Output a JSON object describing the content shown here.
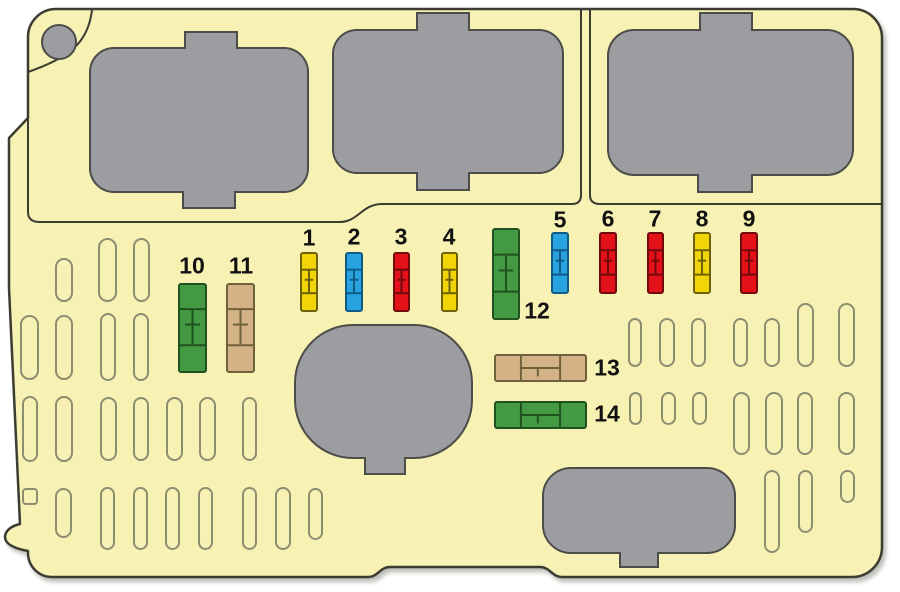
{
  "colors": {
    "canvas_bg": "#ffffff",
    "panel_fill": "#f7f2b4",
    "panel_stroke": "#3c3c33",
    "cover_fill": "#9b9da1",
    "cover_stroke": "#4c4d48",
    "slot_stroke": "#8d8d70",
    "label_color": "#111111"
  },
  "fuse_colors": {
    "yellow": {
      "fill": "#f2d506",
      "stroke": "#6e6106"
    },
    "blue": {
      "fill": "#28a3df",
      "stroke": "#0e5c85"
    },
    "red": {
      "fill": "#e41119",
      "stroke": "#700a0d"
    },
    "green": {
      "fill": "#449a42",
      "stroke": "#1e521f"
    },
    "tan": {
      "fill": "#d3b385",
      "stroke": "#71603c"
    }
  },
  "fuses": [
    {
      "number": "1",
      "color": "yellow",
      "orientation": "vertical",
      "x": 300,
      "y": 252,
      "w": 18,
      "h": 60,
      "label": {
        "x": 309,
        "y": 238
      }
    },
    {
      "number": "2",
      "color": "blue",
      "orientation": "vertical",
      "x": 345,
      "y": 252,
      "w": 18,
      "h": 60,
      "label": {
        "x": 354,
        "y": 237
      }
    },
    {
      "number": "3",
      "color": "red",
      "orientation": "vertical",
      "x": 393,
      "y": 252,
      "w": 17,
      "h": 60,
      "label": {
        "x": 401,
        "y": 237
      }
    },
    {
      "number": "4",
      "color": "yellow",
      "orientation": "vertical",
      "x": 441,
      "y": 252,
      "w": 17,
      "h": 60,
      "label": {
        "x": 449,
        "y": 237
      }
    },
    {
      "number": "5",
      "color": "blue",
      "orientation": "vertical",
      "x": 551,
      "y": 232,
      "w": 18,
      "h": 62,
      "label": {
        "x": 560,
        "y": 220
      }
    },
    {
      "number": "6",
      "color": "red",
      "orientation": "vertical",
      "x": 599,
      "y": 232,
      "w": 18,
      "h": 62,
      "label": {
        "x": 608,
        "y": 219
      }
    },
    {
      "number": "7",
      "color": "red",
      "orientation": "vertical",
      "x": 647,
      "y": 232,
      "w": 17,
      "h": 62,
      "label": {
        "x": 655,
        "y": 219
      }
    },
    {
      "number": "8",
      "color": "yellow",
      "orientation": "vertical",
      "x": 693,
      "y": 232,
      "w": 18,
      "h": 62,
      "label": {
        "x": 702,
        "y": 219
      }
    },
    {
      "number": "9",
      "color": "red",
      "orientation": "vertical",
      "x": 740,
      "y": 232,
      "w": 18,
      "h": 62,
      "label": {
        "x": 749,
        "y": 219
      }
    },
    {
      "number": "10",
      "color": "green",
      "orientation": "vertical",
      "x": 178,
      "y": 283,
      "w": 29,
      "h": 90,
      "label": {
        "x": 192,
        "y": 266
      }
    },
    {
      "number": "11",
      "color": "tan",
      "orientation": "vertical",
      "x": 226,
      "y": 283,
      "w": 29,
      "h": 90,
      "label": {
        "x": 241,
        "y": 266
      }
    },
    {
      "number": "12",
      "color": "green",
      "orientation": "vertical",
      "x": 492,
      "y": 228,
      "w": 28,
      "h": 92,
      "label": {
        "x": 537,
        "y": 311
      }
    },
    {
      "number": "13",
      "color": "tan",
      "orientation": "horizontal",
      "x": 494,
      "y": 354,
      "w": 93,
      "h": 28,
      "label": {
        "x": 607,
        "y": 368
      }
    },
    {
      "number": "14",
      "color": "green",
      "orientation": "horizontal",
      "x": 494,
      "y": 401,
      "w": 93,
      "h": 28,
      "label": {
        "x": 607,
        "y": 414
      }
    }
  ],
  "empty_slots": [
    {
      "x": 55,
      "y": 258,
      "w": 18,
      "h": 44
    },
    {
      "x": 98,
      "y": 238,
      "w": 19,
      "h": 64
    },
    {
      "x": 133,
      "y": 238,
      "w": 17,
      "h": 64
    },
    {
      "x": 20,
      "y": 315,
      "w": 19,
      "h": 65
    },
    {
      "x": 55,
      "y": 315,
      "w": 18,
      "h": 65
    },
    {
      "x": 100,
      "y": 313,
      "w": 16,
      "h": 68
    },
    {
      "x": 133,
      "y": 313,
      "w": 16,
      "h": 68
    },
    {
      "x": 22,
      "y": 396,
      "w": 16,
      "h": 66
    },
    {
      "x": 55,
      "y": 396,
      "w": 18,
      "h": 66
    },
    {
      "x": 100,
      "y": 397,
      "w": 17,
      "h": 64
    },
    {
      "x": 133,
      "y": 397,
      "w": 16,
      "h": 64
    },
    {
      "x": 166,
      "y": 397,
      "w": 17,
      "h": 64
    },
    {
      "x": 199,
      "y": 397,
      "w": 17,
      "h": 64
    },
    {
      "x": 242,
      "y": 397,
      "w": 15,
      "h": 64
    },
    {
      "x": 22,
      "y": 488,
      "w": 16,
      "h": 17,
      "r": 4
    },
    {
      "x": 55,
      "y": 488,
      "w": 17,
      "h": 50
    },
    {
      "x": 100,
      "y": 487,
      "w": 15,
      "h": 63
    },
    {
      "x": 133,
      "y": 487,
      "w": 15,
      "h": 63
    },
    {
      "x": 165,
      "y": 487,
      "w": 15,
      "h": 63
    },
    {
      "x": 198,
      "y": 487,
      "w": 15,
      "h": 63
    },
    {
      "x": 242,
      "y": 487,
      "w": 15,
      "h": 63
    },
    {
      "x": 275,
      "y": 487,
      "w": 16,
      "h": 63
    },
    {
      "x": 308,
      "y": 488,
      "w": 15,
      "h": 52
    },
    {
      "x": 628,
      "y": 318,
      "w": 14,
      "h": 49
    },
    {
      "x": 659,
      "y": 318,
      "w": 16,
      "h": 49
    },
    {
      "x": 691,
      "y": 318,
      "w": 15,
      "h": 49
    },
    {
      "x": 733,
      "y": 318,
      "w": 15,
      "h": 49
    },
    {
      "x": 764,
      "y": 318,
      "w": 16,
      "h": 49
    },
    {
      "x": 797,
      "y": 303,
      "w": 17,
      "h": 64
    },
    {
      "x": 838,
      "y": 303,
      "w": 17,
      "h": 64
    },
    {
      "x": 629,
      "y": 392,
      "w": 13,
      "h": 33
    },
    {
      "x": 661,
      "y": 392,
      "w": 15,
      "h": 33
    },
    {
      "x": 692,
      "y": 392,
      "w": 15,
      "h": 33
    },
    {
      "x": 733,
      "y": 392,
      "w": 17,
      "h": 63
    },
    {
      "x": 765,
      "y": 392,
      "w": 18,
      "h": 63
    },
    {
      "x": 797,
      "y": 392,
      "w": 16,
      "h": 63
    },
    {
      "x": 838,
      "y": 392,
      "w": 17,
      "h": 63
    },
    {
      "x": 764,
      "y": 470,
      "w": 16,
      "h": 83
    },
    {
      "x": 798,
      "y": 470,
      "w": 15,
      "h": 63
    },
    {
      "x": 840,
      "y": 470,
      "w": 15,
      "h": 33
    }
  ]
}
